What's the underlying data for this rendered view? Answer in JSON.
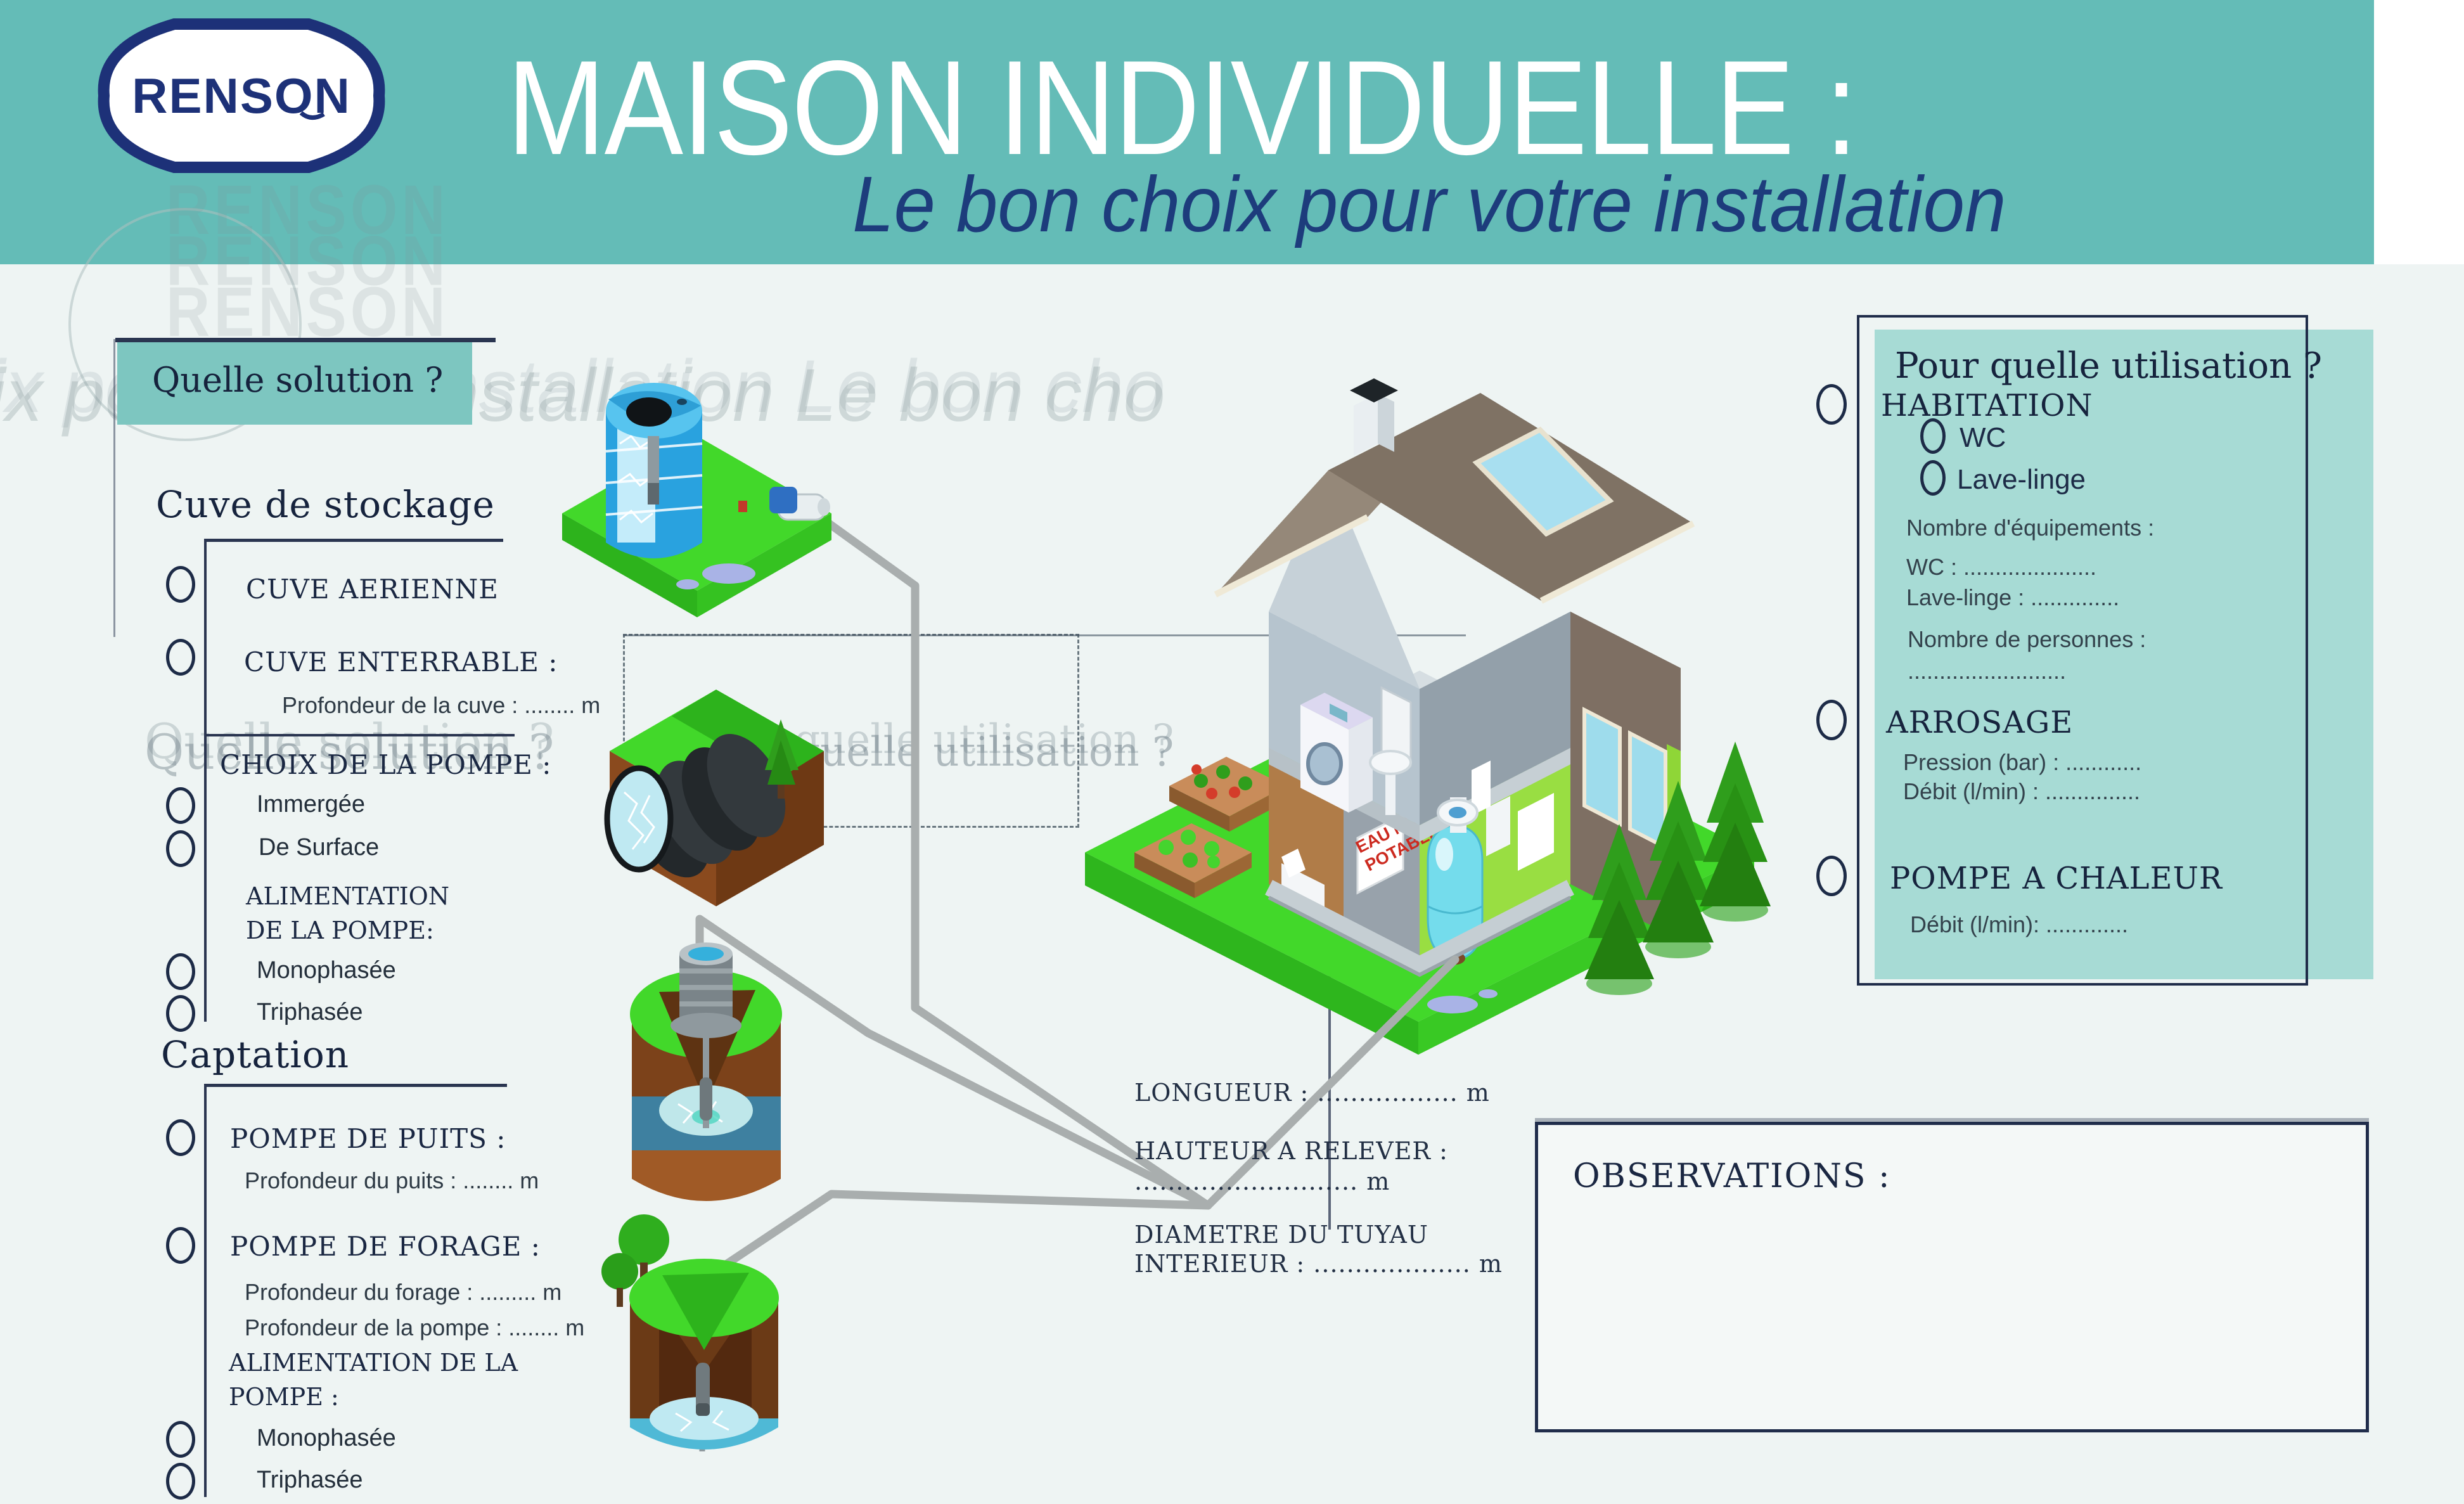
{
  "header": {
    "logo_text": "RENSON",
    "title": "MAISON INDIVIDUELLE :",
    "subtitle": "Le bon choix pour votre installation"
  },
  "ghosts": {
    "renson": "RENSON",
    "subtitle_echo": "ix pour votre installation      Le bon cho",
    "solution": "Quelle solution ?",
    "utilisation": "Pour quelle utilisation ?"
  },
  "solution_box": {
    "label": "Quelle solution ?"
  },
  "storage": {
    "heading": "Cuve de stockage",
    "opt_aerienne": "CUVE AERIENNE",
    "opt_enterrable": "CUVE ENTERRABLE :",
    "enterrable_sub": "Profondeur de la cuve : ........ m",
    "pump_choice": "CHOIX DE LA POMPE :",
    "opt_immergee": "Immergée",
    "opt_surface": "De Surface",
    "alim_1": "ALIMENTATION",
    "alim_2": "DE LA POMPE:",
    "opt_mono": "Monophasée",
    "opt_tri": "Triphasée"
  },
  "captation": {
    "heading": "Captation",
    "opt_puits": "POMPE DE PUITS :",
    "puits_sub": "Profondeur du puits : ........ m",
    "opt_forage": "POMPE DE FORAGE :",
    "forage_sub1": "Profondeur du forage : ......... m",
    "forage_sub2": "Profondeur de la pompe : ........ m",
    "alim_1": "ALIMENTATION DE LA",
    "alim_2": "POMPE :",
    "opt_mono": "Monophasée",
    "opt_tri": "Triphasée"
  },
  "measurements": {
    "longueur": "LONGUEUR : ................. m",
    "hauteur_label": "HAUTEUR A RELEVER :",
    "hauteur_dots": "........................... m",
    "diametre_1": "DIAMETRE DU TUYAU",
    "diametre_2": "INTERIEUR : ................... m"
  },
  "usage_panel": {
    "title": "Pour quelle utilisation ?",
    "habitation": "HABITATION",
    "wc": "WC",
    "lave_linge": "Lave-linge",
    "equip_label": "Nombre d'équipements :",
    "wc_line": "WC : .....................",
    "lave_line": "Lave-linge : ..............",
    "personnes_label": "Nombre de personnes :",
    "personnes_line": ".........................",
    "arrosage": "ARROSAGE",
    "pression_line": "Pression (bar) : ............",
    "debit_line": "Débit (l/min) :  ...............",
    "pac": "POMPE A CHALEUR",
    "pac_debit_line": "Débit (l/min): ............."
  },
  "observations": {
    "label": "OBSERVATIONS :"
  },
  "house": {
    "sign_line1": "EAU NON",
    "sign_line2": "POTABLE"
  }
}
